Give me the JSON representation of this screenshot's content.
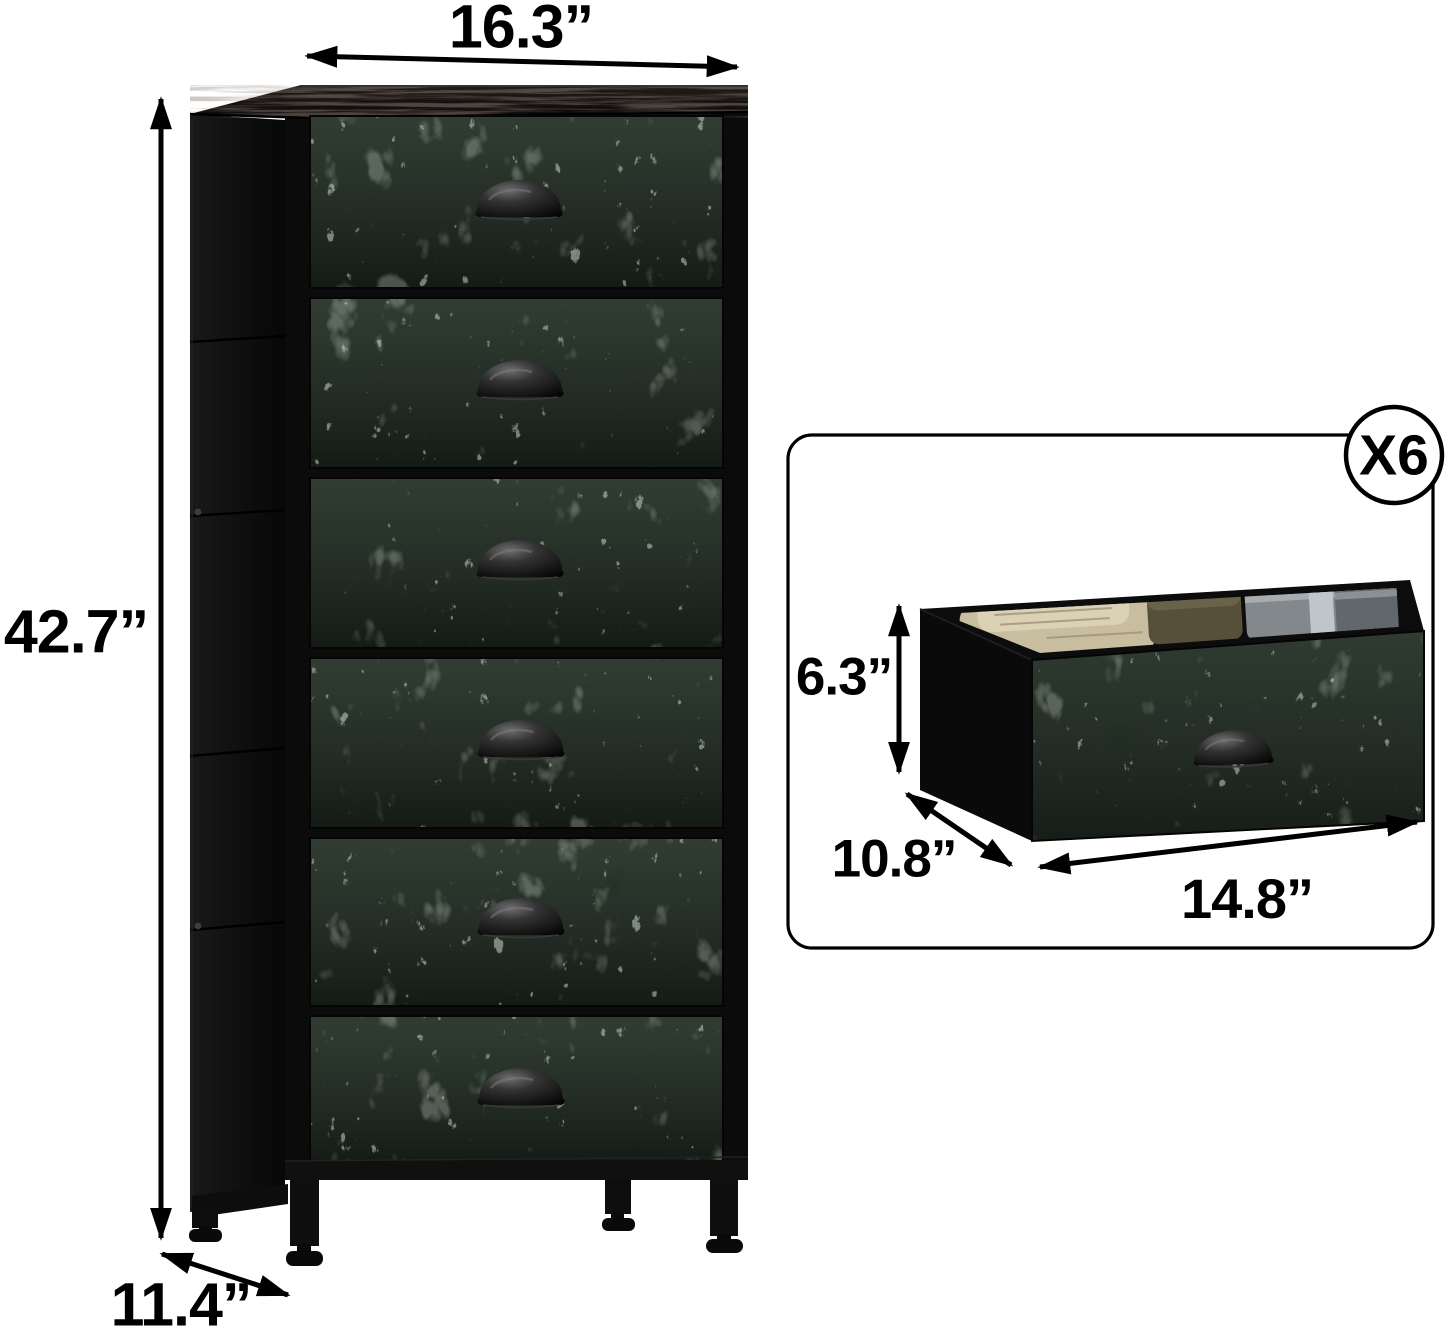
{
  "page": {
    "background": "#ffffff"
  },
  "main_view": {
    "drawer_count": 6,
    "dimensions": {
      "width": "16.3”",
      "height": "42.7”",
      "depth": "11.4”"
    }
  },
  "inset_view": {
    "badge": "X6",
    "dimensions": {
      "height": "6.3”",
      "depth": "10.8”",
      "width": "14.8”"
    }
  },
  "palette": {
    "arrow_color": "#000000",
    "frame_color": "#0b0b0b",
    "drawer_base": "#2e3a30",
    "drawer_vein": "#93a693",
    "wood_top": "#1c1714",
    "cloth_beige": "#cdc2a4",
    "cloth_olive": "#564f3a",
    "cloth_gray": "#83888c"
  }
}
